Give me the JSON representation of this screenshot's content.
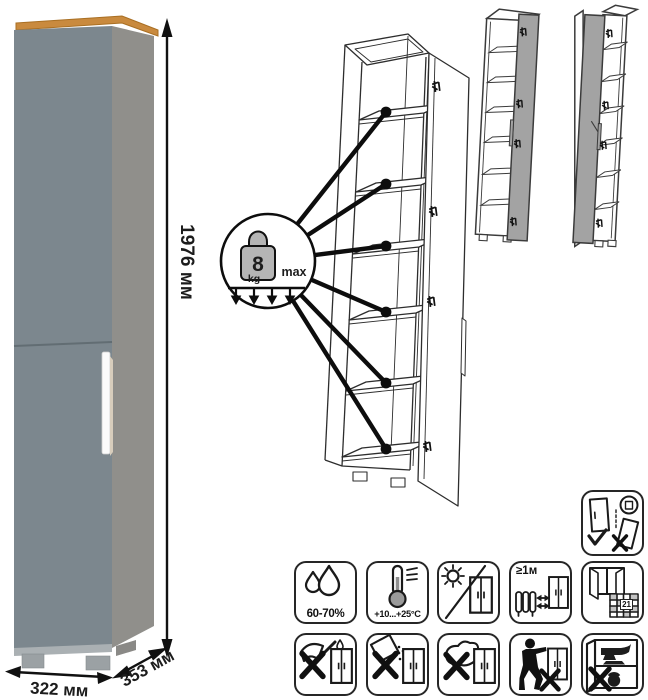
{
  "dimensions": {
    "height": "1976 мм",
    "width": "322 мм",
    "depth": "353 мм"
  },
  "load_limit": {
    "value": "8",
    "unit": "kg",
    "qualifier": "max",
    "shelves_indicated": 6
  },
  "care_icons": [
    {
      "name": "humidity",
      "label": "60-70%"
    },
    {
      "name": "temperature",
      "label": "+10...+25°C"
    },
    {
      "name": "no-direct-sunlight",
      "label": ""
    },
    {
      "name": "keep-distance-from-heat",
      "label": "≥1м"
    },
    {
      "name": "ventilation-acclimatization",
      "label": "21"
    },
    {
      "name": "no-sharp-objects",
      "label": ""
    },
    {
      "name": "no-abrasive-powders",
      "label": ""
    },
    {
      "name": "no-wet-cleaning",
      "label": ""
    },
    {
      "name": "no-dragging",
      "label": ""
    },
    {
      "name": "no-heavy-items",
      "label": ""
    }
  ],
  "colors": {
    "front_panel": "#7c878e",
    "side_panel": "#908f8b",
    "top_wood": "#c98a3e",
    "handle": "#fbfbfb",
    "diagram_door_gray": "#a3a3a3"
  }
}
